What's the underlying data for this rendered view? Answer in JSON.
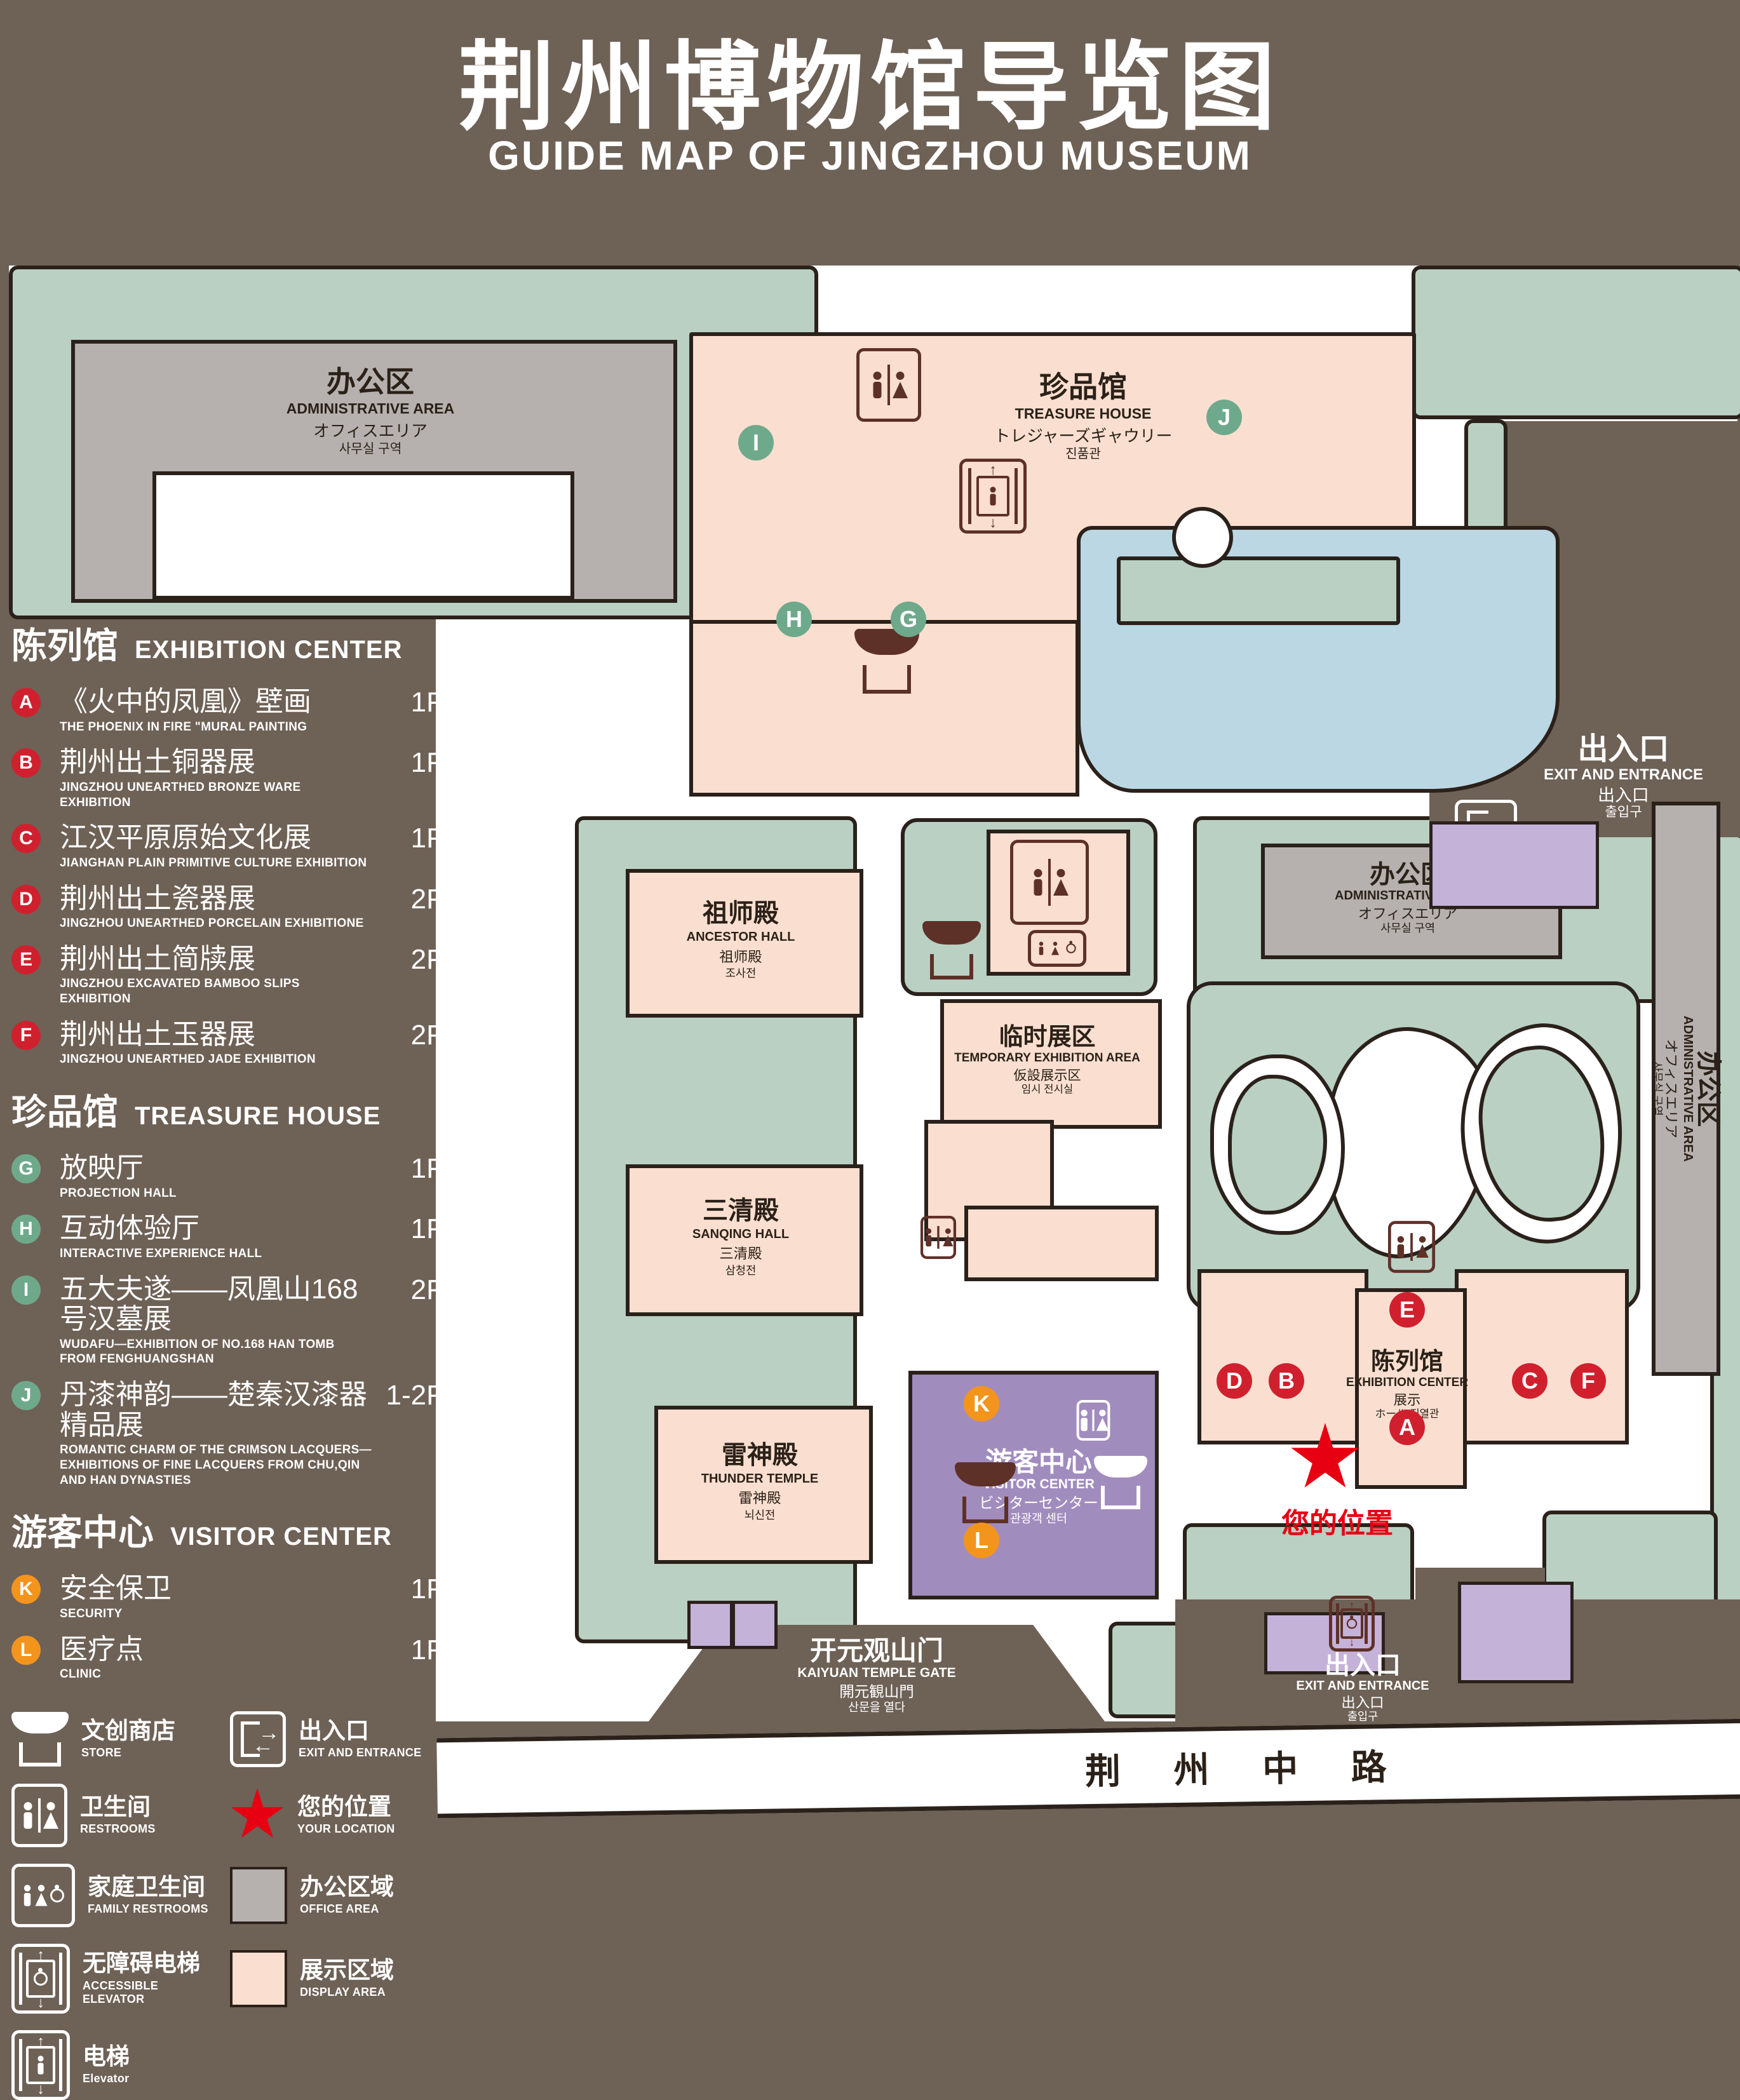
{
  "header": {
    "title_zh": "荆州博物馆导览图",
    "title_en": "GUIDE MAP OF JINGZHOU MUSEUM"
  },
  "sidebar": {
    "sections": [
      {
        "heading_zh": "陈列馆",
        "heading_en": "EXHIBITION CENTER",
        "items": [
          {
            "letter": "A",
            "zh": "《火中的凤凰》壁画",
            "en": "THE PHOENIX IN FIRE \"MURAL PAINTING",
            "floor": "1F"
          },
          {
            "letter": "B",
            "zh": "荆州出土铜器展",
            "en": "JINGZHOU UNEARTHED BRONZE WARE EXHIBITION",
            "floor": "1F"
          },
          {
            "letter": "C",
            "zh": "江汉平原原始文化展",
            "en": "JIANGHAN PLAIN PRIMITIVE CULTURE EXHIBITION",
            "floor": "1F"
          },
          {
            "letter": "D",
            "zh": "荆州出土瓷器展",
            "en": "JINGZHOU UNEARTHED PORCELAIN EXHIBITIONE",
            "floor": "2F"
          },
          {
            "letter": "E",
            "zh": "荆州出土简牍展",
            "en": "JINGZHOU EXCAVATED BAMBOO SLIPS EXHIBITION",
            "floor": "2F"
          },
          {
            "letter": "F",
            "zh": "荆州出土玉器展",
            "en": "JINGZHOU UNEARTHED JADE EXHIBITION",
            "floor": "2F"
          }
        ]
      },
      {
        "heading_zh": "珍品馆",
        "heading_en": "TREASURE HOUSE",
        "items": [
          {
            "letter": "G",
            "zh": "放映厅",
            "en": "PROJECTION HALL",
            "floor": "1F"
          },
          {
            "letter": "H",
            "zh": "互动体验厅",
            "en": "INTERACTIVE EXPERIENCE HALL",
            "floor": "1F"
          },
          {
            "letter": "I",
            "zh": "五大夫遂——凤凰山168号汉墓展",
            "en": "WUDAFU—EXHIBITION OF NO.168 HAN TOMB FROM FENGHUANGSHAN",
            "floor": "2F"
          },
          {
            "letter": "J",
            "zh": "丹漆神韵——楚秦汉漆器精品展",
            "en": "ROMANTIC CHARM OF THE CRIMSON LACQUERS—EXHIBITIONS OF FINE LACQUERS FROM CHU,QIN AND HAN DYNASTIES",
            "floor": "1-2F"
          }
        ]
      },
      {
        "heading_zh": "游客中心",
        "heading_en": "VISITOR CENTER",
        "items": [
          {
            "letter": "K",
            "zh": "安全保卫",
            "en": "SECURITY",
            "floor": "1F"
          },
          {
            "letter": "L",
            "zh": "医疗点",
            "en": "CLINIC",
            "floor": "1F"
          }
        ]
      }
    ],
    "legend": [
      {
        "icon": "store-icon",
        "zh": "文创商店",
        "en": "STORE"
      },
      {
        "icon": "exit-icon",
        "zh": "出入口",
        "en": "EXIT AND ENTRANCE"
      },
      {
        "icon": "restroom-icon",
        "zh": "卫生间",
        "en": "RESTROOMS"
      },
      {
        "icon": "location-star-icon",
        "zh": "您的位置",
        "en": "YOUR LOCATION"
      },
      {
        "icon": "family-restroom-icon",
        "zh": "家庭卫生间",
        "en": "FAMILY RESTROOMS"
      },
      {
        "icon": "office-area-swatch",
        "zh": "办公区域",
        "en": "OFFICE AREA"
      },
      {
        "icon": "accessible-elevator-icon",
        "zh": "无障碍电梯",
        "en": "ACCESSIBLE ELEVATOR"
      },
      {
        "icon": "display-area-swatch",
        "zh": "展示区域",
        "en": "DISPLAY AREA"
      },
      {
        "icon": "elevator-icon",
        "zh": "电梯",
        "en": "Elevator"
      }
    ]
  },
  "map": {
    "buildings": {
      "admin_topleft": {
        "zh": "办公区",
        "en": "ADMINISTRATIVE AREA",
        "jp": "オフィスエリア",
        "kr": "사무실 구역"
      },
      "treasure": {
        "zh": "珍品馆",
        "en": "TREASURE HOUSE",
        "jp": "トレジャーズギャウリー",
        "kr": "진품관"
      },
      "ancestor": {
        "zh": "祖师殿",
        "en": "ANCESTOR HALL",
        "jp": "祖师殿",
        "kr": "조사전"
      },
      "temporary": {
        "zh": "临时展区",
        "en": "TEMPORARY EXHIBITION AREA",
        "jp": "仮設展示区",
        "kr": "임시 전시실"
      },
      "admin_right": {
        "zh": "办公区",
        "en": "ADMINISTRATIVE AREA",
        "jp": "オフィスエリア",
        "kr": "사무실 구역"
      },
      "admin_side": {
        "zh": "办公区",
        "en": "ADMINISTRATIVE AREA",
        "jp": "オフィスエリア",
        "kr": "사무실 구역"
      },
      "sanqing": {
        "zh": "三清殿",
        "en": "SANQING HALL",
        "jp": "三清殿",
        "kr": "삼청전"
      },
      "thunder": {
        "zh": "雷神殿",
        "en": "THUNDER TEMPLE",
        "jp": "雷神殿",
        "kr": "뇌신전"
      },
      "visitor": {
        "zh": "游客中心",
        "en": "VISITOR CENTER",
        "jp": "ビジターセンター",
        "kr": "관광객 센터"
      },
      "exhibition": {
        "zh": "陈列馆",
        "en": "EXHIBITION CENTER",
        "jp": "展示",
        "kr": "ホール 진열관"
      }
    },
    "exit_right": {
      "zh": "出入口",
      "en": "EXIT AND ENTRANCE",
      "jp": "出入口",
      "kr": "출입구"
    },
    "exit_bottom": {
      "zh": "出入口",
      "en": "EXIT AND ENTRANCE",
      "jp": "出入口",
      "kr": "출입구"
    },
    "gate": {
      "zh": "开元观山门",
      "en": "KAIYUAN TEMPLE GATE",
      "jp": "開元観山門",
      "kr": "산문을 열다"
    },
    "road": "荆 州 中 路",
    "your_location": "您的位置",
    "markers": {
      "a": "A",
      "b": "B",
      "c": "C",
      "d": "D",
      "e": "E",
      "f": "F",
      "g": "G",
      "h": "H",
      "i": "I",
      "j": "J",
      "k": "K",
      "l": "L"
    }
  },
  "colors": {
    "accent_red": "#d0202e",
    "accent_green": "#6fa98c",
    "accent_orange": "#f3941d",
    "display_area": "#fadfd0",
    "office_area": "#b6b1ae",
    "campus_green": "#b9d0c3",
    "lake_blue": "#bad7e3",
    "visitor_purple": "#a18cbe",
    "background_brown": "#6e6156",
    "location_red": "#e60012"
  }
}
